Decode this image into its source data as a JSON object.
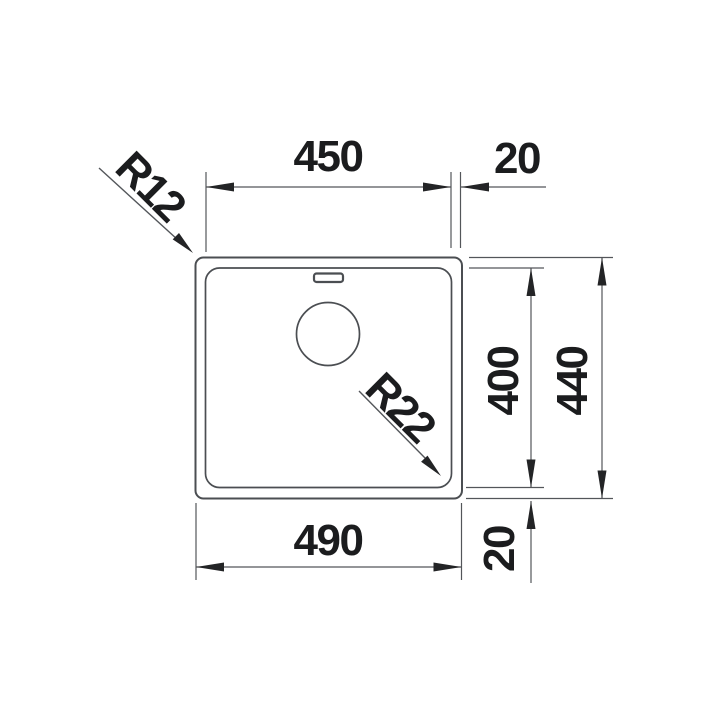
{
  "colors": {
    "background": "#ffffff",
    "outline": "#4b4e52",
    "dimension_line": "#53565a",
    "arrow": "#232426",
    "text": "#1b1c1e"
  },
  "dimensions": {
    "bowl_width": "450",
    "rim_offset_top": "20",
    "bowl_depth": "400",
    "overall_depth": "440",
    "overall_width": "490",
    "rim_offset_bottom": "20",
    "outer_corner_radius": "R12",
    "bowl_corner_radius": "R22"
  }
}
